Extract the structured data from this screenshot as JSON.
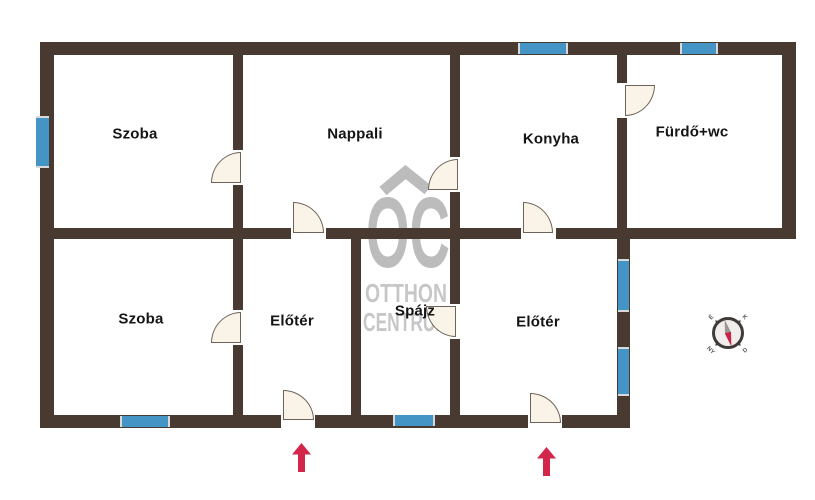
{
  "plan": {
    "rooms": [
      {
        "id": "szoba-1",
        "label": "Szoba"
      },
      {
        "id": "nappali",
        "label": "Nappali"
      },
      {
        "id": "konyha",
        "label": "Konyha"
      },
      {
        "id": "furdo-wc",
        "label": "Fürdő+wc"
      },
      {
        "id": "szoba-2",
        "label": "Szoba"
      },
      {
        "id": "eloter-1",
        "label": "Előtér"
      },
      {
        "id": "spajz",
        "label": "Spájz"
      },
      {
        "id": "eloter-2",
        "label": "Előtér"
      }
    ]
  },
  "watermark": {
    "initials": "OC",
    "line1": "OTTHON",
    "line2": "CENTRUM"
  },
  "compass": {
    "labels": {
      "nw": "É",
      "ne": "K",
      "se": "D",
      "sw": "NY"
    }
  },
  "colors": {
    "wall": "#483A30",
    "window": "#4494C6",
    "door_fill": "#FAF3E7",
    "door_stroke": "#6E6358",
    "watermark_logo": "#BCBCBC",
    "watermark_text": "#C7C7C7",
    "arrow": "#D2274B",
    "compass_ring": "#3E3B38",
    "compass_face": "#F0EDEA",
    "compass_needle_gray": "#9B9894",
    "compass_needle_red": "#C9234A"
  }
}
